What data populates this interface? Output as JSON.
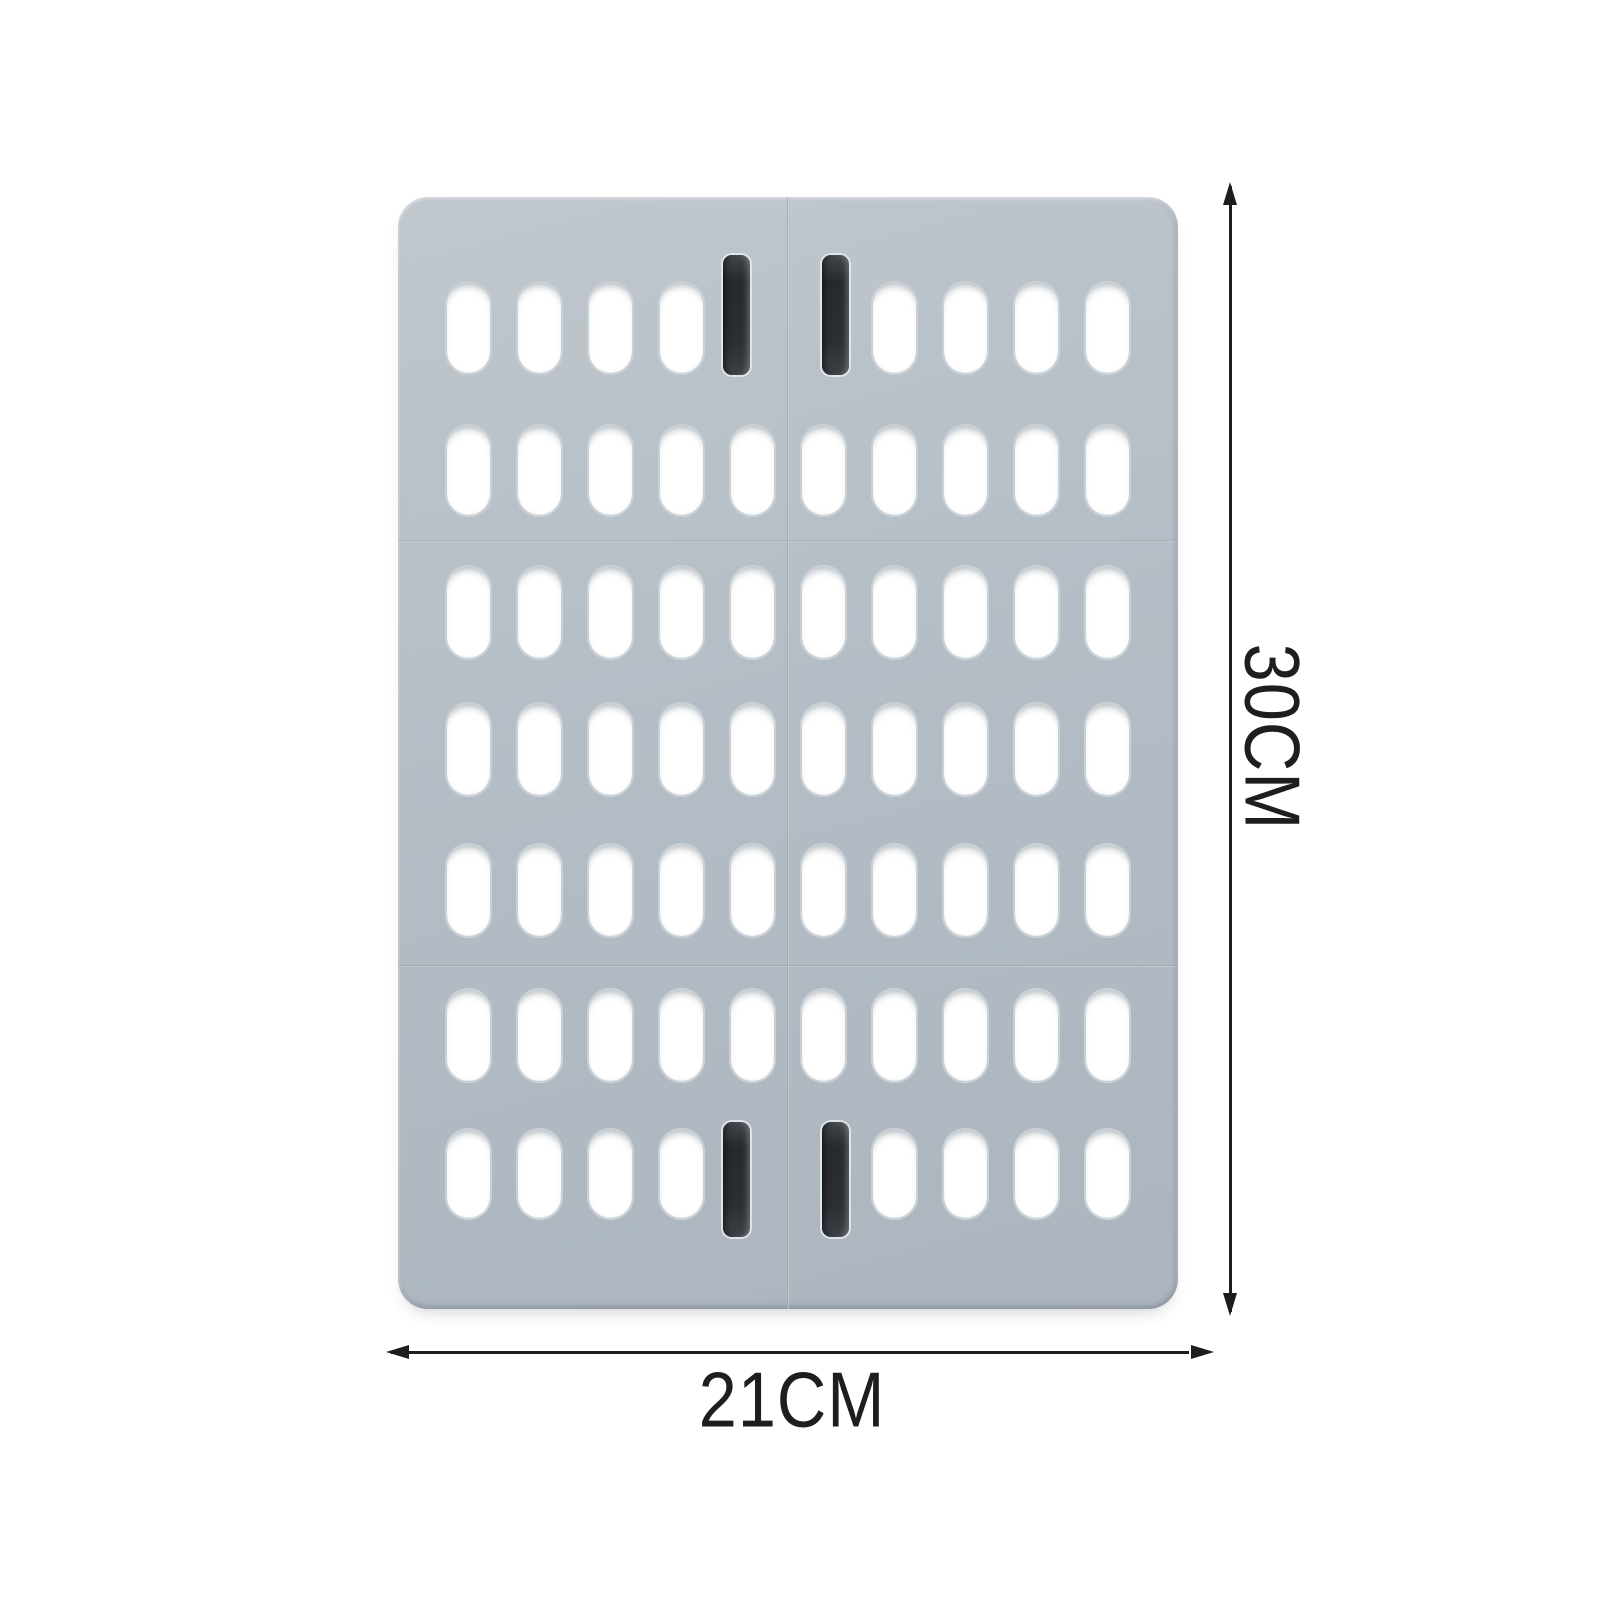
{
  "scene": {
    "description": "foldable perforated drain board product photo with dimension arrows",
    "background_color": "#ffffff"
  },
  "product": {
    "name": "foldable-drain-board",
    "board_color": "#b4bdc5",
    "slot_color": "#ffffff",
    "handle_color": "#2b2e33",
    "annotation_color": "#1d1d1d"
  },
  "annotations": {
    "height": {
      "label": "30CM"
    },
    "width": {
      "label": "21CM"
    }
  },
  "board": {
    "x": 398,
    "y": 197,
    "w": 780,
    "h": 1112,
    "r": 30,
    "seam_v_x": 389,
    "seam_h_ys": [
      343,
      768
    ],
    "slot_w": 47,
    "rows": [
      {
        "y": 84,
        "h": 94,
        "slots": [
          47,
          118,
          189,
          260,
          473,
          544,
          615,
          686
        ]
      },
      {
        "y": 227,
        "h": 93,
        "slots": [
          47,
          118,
          189,
          260,
          331,
          402,
          473,
          544,
          615,
          686
        ]
      },
      {
        "y": 368,
        "h": 95,
        "slots": [
          47,
          118,
          189,
          260,
          331,
          402,
          473,
          544,
          615,
          686
        ]
      },
      {
        "y": 505,
        "h": 95,
        "slots": [
          47,
          118,
          189,
          260,
          331,
          402,
          473,
          544,
          615,
          686
        ]
      },
      {
        "y": 646,
        "h": 95,
        "slots": [
          47,
          118,
          189,
          260,
          331,
          402,
          473,
          544,
          615,
          686
        ]
      },
      {
        "y": 791,
        "h": 95,
        "slots": [
          47,
          118,
          189,
          260,
          331,
          402,
          473,
          544,
          615,
          686
        ]
      },
      {
        "y": 931,
        "h": 92,
        "slots": [
          47,
          118,
          189,
          260,
          473,
          544,
          615,
          686
        ]
      }
    ],
    "handles": [
      {
        "x": 325,
        "y": 58,
        "w": 27,
        "h": 120
      },
      {
        "x": 424,
        "y": 58,
        "w": 27,
        "h": 120
      },
      {
        "x": 325,
        "y": 925,
        "w": 27,
        "h": 115
      },
      {
        "x": 424,
        "y": 925,
        "w": 27,
        "h": 115
      }
    ]
  }
}
